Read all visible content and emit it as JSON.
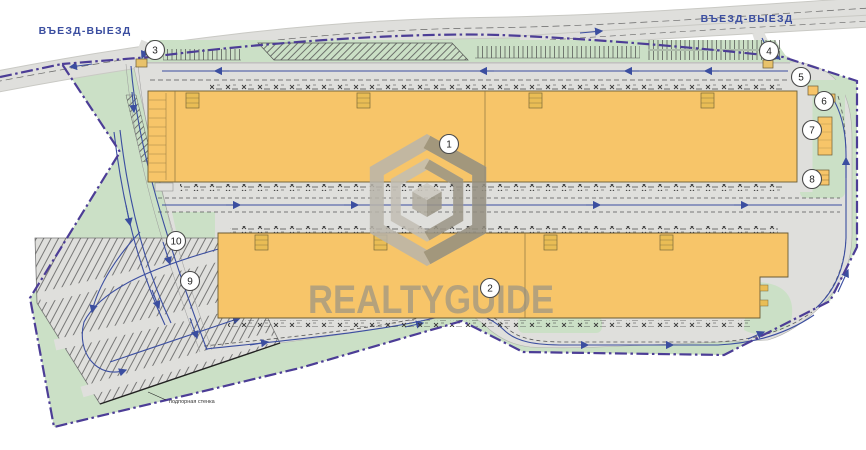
{
  "labels": {
    "entrance_left": "ВЪЕЗД-ВЫЕЗД",
    "entrance_right": "ВЪЕЗД-ВЫЕЗД",
    "retaining_wall": "подпорная стенка",
    "watermark": "REALTYGUIDE"
  },
  "markers": [
    {
      "label": "1",
      "x": 449,
      "y": 144
    },
    {
      "label": "2",
      "x": 490,
      "y": 288
    },
    {
      "label": "3",
      "x": 155,
      "y": 50
    },
    {
      "label": "4",
      "x": 769,
      "y": 51
    },
    {
      "label": "5",
      "x": 801,
      "y": 77
    },
    {
      "label": "6",
      "x": 824,
      "y": 101
    },
    {
      "label": "7",
      "x": 812,
      "y": 130
    },
    {
      "label": "8",
      "x": 812,
      "y": 179
    },
    {
      "label": "9",
      "x": 190,
      "y": 281
    },
    {
      "label": "10",
      "x": 176,
      "y": 241
    }
  ],
  "colors": {
    "building_fill": "#F7C569",
    "landscape_green": "#CBE0C6",
    "road_gray": "#DFDFDC",
    "boundary_purple": "#4C3D96",
    "traffic_blue": "#3B4EA0",
    "watermark_gray": "#8D8D89",
    "entrance_label_blue": "#3B4EA0"
  }
}
